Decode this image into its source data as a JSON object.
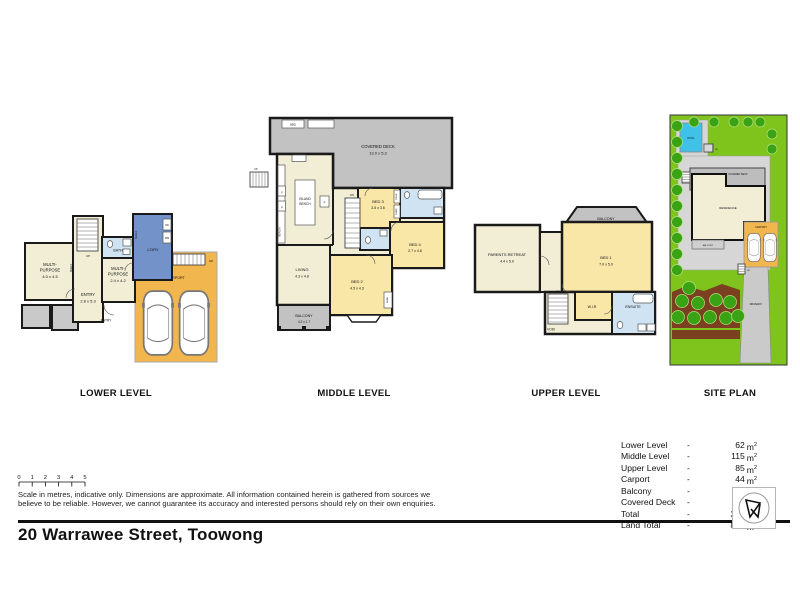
{
  "address": "20 Warrawee Street, Toowong",
  "titles": {
    "lower": "LOWER LEVEL",
    "middle": "MIDDLE LEVEL",
    "upper": "UPPER LEVEL",
    "site": "SITE PLAN"
  },
  "scalebar": {
    "ticks": [
      "0",
      "1",
      "2",
      "3",
      "4",
      "5"
    ]
  },
  "disclaimer": {
    "line1": "Scale in metres, indicative only. Dimensions are approximate. All information contained herein is gathered from sources we",
    "line2": "believe to be reliable. However, we cannot guarantee its accuracy and interested persons should rely on their own enquiries."
  },
  "areas": {
    "dash": "-",
    "unit": "m",
    "unit_sup": "2",
    "rows": [
      {
        "label": "Lower Level",
        "value": "62"
      },
      {
        "label": "Middle Level",
        "value": "115"
      },
      {
        "label": "Upper Level",
        "value": "85"
      },
      {
        "label": "Carport",
        "value": "44"
      },
      {
        "label": "Balcony",
        "value": "15"
      },
      {
        "label": "Covered Deck",
        "value": "57"
      },
      {
        "label": "Total",
        "value": "378"
      },
      {
        "label": "Land Total",
        "value": "822"
      }
    ]
  },
  "lower": {
    "multi1": {
      "l1": "MULTI-",
      "l2": "PURPOSE",
      "l3": "4.0 x 4.5"
    },
    "entry": {
      "l1": "ENTRY",
      "l2": "2.8 x 5.3"
    },
    "multi2": {
      "l1": "MULTI-",
      "l2": "PURPOSE",
      "l3": "2.4 x 4.2"
    },
    "bath": "BATH",
    "ldry": "L'DRY",
    "carport": "CARPORT",
    "shelf1": "SHELF",
    "shelf2": "SHELF",
    "up1": "UP",
    "up2": "UP",
    "dr": "DR",
    "wm": "WM",
    "entry_door": "ENTRY"
  },
  "middle": {
    "deck": {
      "l1": "COVERED DECK",
      "l2": "13.0 x 5.3"
    },
    "bbq": "BBQ",
    "up": "UP",
    "dn": "DN",
    "island": {
      "l1": "ISLAND",
      "l2": "BENCH"
    },
    "bench": "BENCH",
    "f": "F",
    "p1": "P",
    "p2": "P",
    "bed3": {
      "l1": "BED 3",
      "l2": "3.5 x 3.6"
    },
    "bed4": {
      "l1": "BED 4",
      "l2": "2.7 x 4.6"
    },
    "bed2": {
      "l1": "BED 2",
      "l2": "4.5 x 4.3"
    },
    "living": {
      "l1": "LIVING",
      "l2": "4.3 x 4.8"
    },
    "balcony": {
      "l1": "BALCONY",
      "l2": "4.2 x 1.7"
    },
    "desk": "DESK",
    "robe1": "ROBE",
    "robe2": "ROBE"
  },
  "upper": {
    "parents": {
      "l1": "PARENTS RETREAT",
      "l2": "4.4 x 5.0"
    },
    "bed1": {
      "l1": "BED 1",
      "l2": "7.0 x 5.0"
    },
    "balcony": "BALCONY",
    "wir": "W.I.R",
    "ensuite": "ENSUITE",
    "void": "VOID",
    "dn": "DN"
  },
  "site": {
    "pool": "POOL",
    "deck": "COVERED DECK",
    "residence": "RESIDENCE",
    "balcony": "BALCONY",
    "carport": "CARPORT",
    "driveway": "DRIVEWAY",
    "up1": "UP",
    "up2": "UP",
    "up3": "UP"
  },
  "colors": {
    "cream": "#f1eed5",
    "yellow": "#f9e7a8",
    "blue": "#7492ca",
    "lightblue": "#cfe3f2",
    "gray": "#c2c2c2",
    "orange": "#f2b64f",
    "lawn": "#7fc41d",
    "tree": "#3aa315",
    "pool": "#3fc1e8",
    "soil": "#7a401f",
    "paving": "#d6d6d6",
    "wall": "#1a1a1a"
  }
}
